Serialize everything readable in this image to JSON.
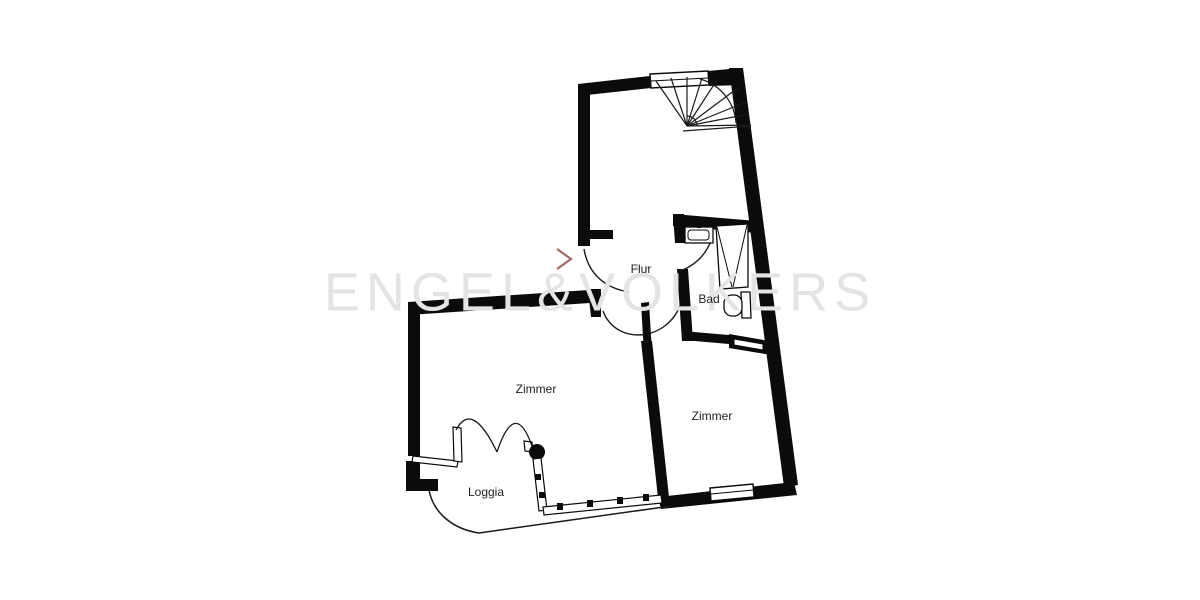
{
  "title": "Apartment floor plan",
  "watermark": {
    "text": "ENGEL&VÖLKERS",
    "color": "#e4e4e4"
  },
  "rooms": [
    {
      "name": "flur",
      "label": "Flur"
    },
    {
      "name": "bad",
      "label": "Bad"
    },
    {
      "name": "zimmer_left",
      "label": "Zimmer"
    },
    {
      "name": "zimmer_right",
      "label": "Zimmer"
    },
    {
      "name": "loggia",
      "label": "Loggia"
    }
  ],
  "colors": {
    "wall": "#0b0b0b",
    "background": "#ffffff",
    "watermark": "#e4e4e4",
    "entrance_marker": "#a66a66",
    "label_text": "#1f1f1f"
  },
  "fixtures": [
    "winder-staircase",
    "entrance-door",
    "interior-door",
    "bathroom-door",
    "bathroom-sink",
    "shower",
    "toilet",
    "french-double-door",
    "loggia-railing",
    "window"
  ]
}
